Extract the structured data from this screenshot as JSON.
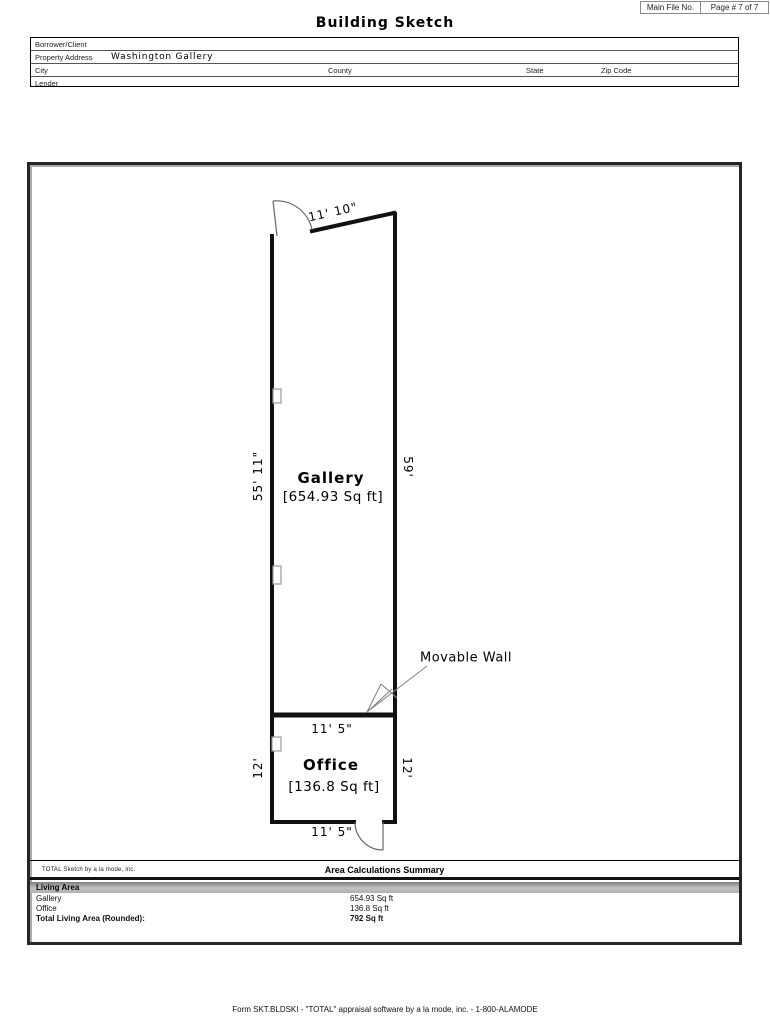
{
  "page": {
    "title": "Building Sketch",
    "main_file_label": "Main File No.",
    "page_number_label": "Page # 7 of 7",
    "footer": "Form SKT.BLDSKI - \"TOTAL\" appraisal software by a la mode, inc. - 1-800-ALAMODE"
  },
  "form": {
    "borrower_label": "Borrower/Client",
    "property_address_label": "Property Address",
    "property_address_value": "Washington Gallery",
    "city_label": "City",
    "county_label": "County",
    "state_label": "State",
    "zip_label": "Zip Code",
    "lender_label": "Lender"
  },
  "sketch": {
    "rooms": [
      {
        "name": "Gallery",
        "area": "[654.93 Sq ft]"
      },
      {
        "name": "Office",
        "area": "[136.8 Sq ft]"
      }
    ],
    "dimensions": {
      "top": "11' 10\"",
      "gallery_left": "55' 11\"",
      "gallery_right": "59'",
      "office_top": "11' 5\"",
      "office_left": "12'",
      "office_right": "12'",
      "office_bottom": "11' 5\""
    },
    "annotation": "Movable Wall",
    "credit": "TOTAL Sketch by a la mode, inc."
  },
  "summary": {
    "title": "Area Calculations Summary",
    "section_label": "Living Area",
    "rows": [
      {
        "label": "Gallery",
        "value": "654.93 Sq ft"
      },
      {
        "label": "Office",
        "value": "136.8 Sq ft"
      }
    ],
    "total_label": "Total Living Area (Rounded):",
    "total_value": "792 Sq ft"
  },
  "colors": {
    "ink": "#111111",
    "thin_line": "#888888",
    "section_bar_gray": "#b3b3b3"
  }
}
